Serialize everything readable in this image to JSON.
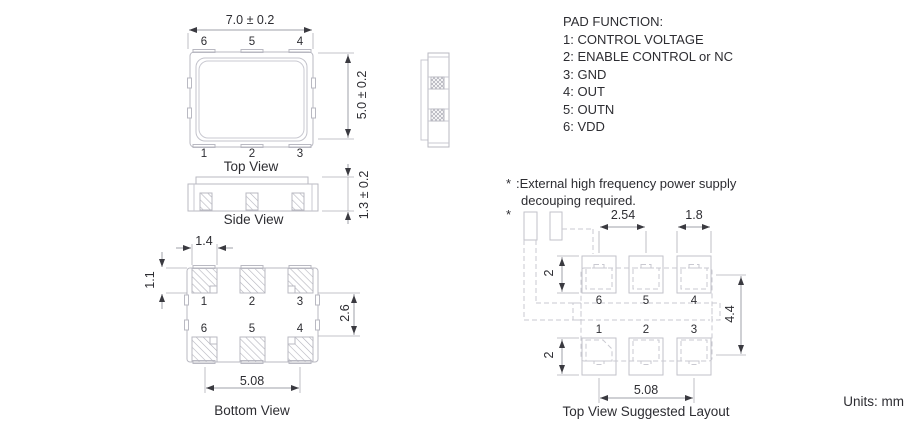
{
  "units_label": "Units: mm",
  "pad_function": {
    "title": "PAD FUNCTION:",
    "items": [
      "1: CONTROL VOLTAGE",
      "2: ENABLE CONTROL or NC",
      "3: GND",
      "4: OUT",
      "5: OUTN",
      "6: VDD"
    ]
  },
  "note": {
    "marker": "*",
    "line1": ":External high frequency power supply",
    "line2": "decouping required."
  },
  "top_view": {
    "label": "Top View",
    "dim_width": "7.0 ± 0.2",
    "dim_height": "5.0 ± 0.2",
    "pins_top": [
      "6",
      "5",
      "4"
    ],
    "pins_bottom": [
      "1",
      "2",
      "3"
    ]
  },
  "side_view": {
    "label": "Side View",
    "dim_thickness": "1.3 ± 0.2"
  },
  "bottom_view": {
    "label": "Bottom View",
    "dim_pad_width": "1.4",
    "dim_pad_height": "1.1",
    "dim_row_gap": "2.6",
    "dim_pitch": "5.08",
    "pins_top": [
      "1",
      "2",
      "3"
    ],
    "pins_bottom": [
      "6",
      "5",
      "4"
    ]
  },
  "layout_view": {
    "label": "Top View Suggested Layout",
    "asterisk": "*",
    "dim_pitch_top": "2.54",
    "dim_pad_width": "1.8",
    "dim_pad_height_top": "2",
    "dim_pad_height_bottom": "2",
    "dim_row_span": "4.4",
    "dim_pitch_bottom": "5.08",
    "pins_top": [
      "6",
      "5",
      "4"
    ],
    "pins_bottom": [
      "1",
      "2",
      "3"
    ]
  },
  "colors": {
    "outline": "#b9b9c2",
    "dashed": "#c9c9d1",
    "dimension_line": "#9fa0a8",
    "arrow": "#3a3a40",
    "text": "#2d2d32",
    "hatch": "#b2b2bb"
  }
}
